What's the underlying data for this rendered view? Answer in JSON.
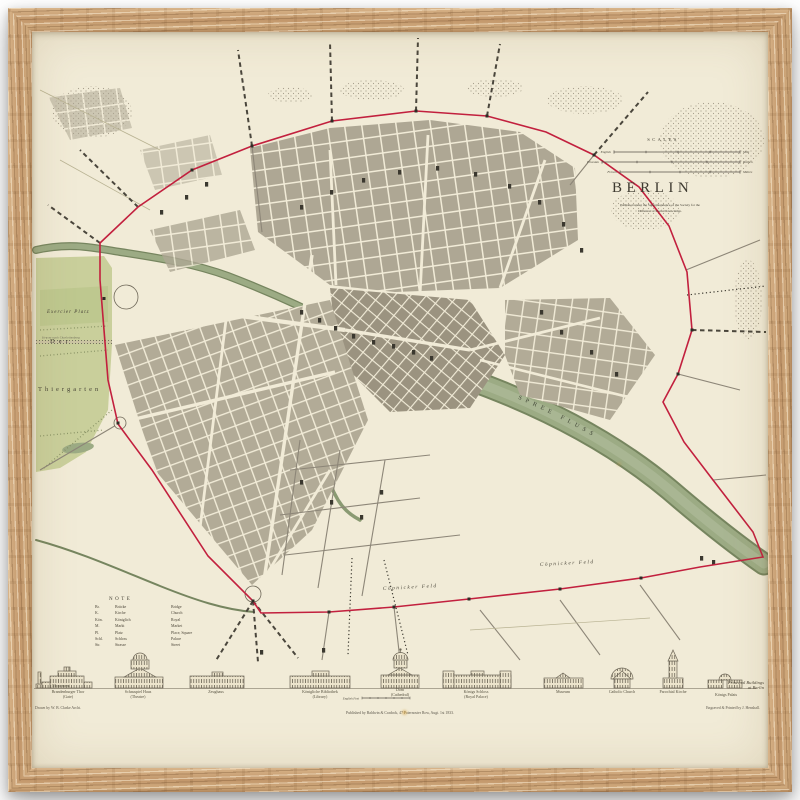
{
  "map": {
    "title": "BERLIN",
    "subtitle_1": "Published under the Superintendence of the Society for the",
    "subtitle_2": "Diffusion of Useful Knowledge.",
    "scales": {
      "heading": "SCALES",
      "rows": [
        {
          "left": "English",
          "right": "Mile"
        },
        {
          "left": "Prussian",
          "right": "Ruthen"
        },
        {
          "left": "French",
          "right": "Mètres"
        }
      ]
    },
    "labels": {
      "exercier_platz": "Exercier Platz",
      "der": "Der",
      "thiergarten": "Thiergarten",
      "charlottenburg_road": "Strasse nach Charlottenburg",
      "river": "SPREE FLUSS",
      "coepnicker_feld_w": "Cöpnicker Feld",
      "coepnicker_feld_e": "Cöpnicker Feld"
    },
    "note": {
      "heading": "NOTE",
      "abbreviations": "Br.\nK.\nKön.\nM.\nPl.\nSchl.\nStr.",
      "german": "Brücke\nKirche\nKöniglich\nMarkt\nPlatz\nSchloss\nStrasse",
      "english": "Bridge\nChurch\nRoyal\nMarket\nPlace, Square\nPalace\nStreet"
    },
    "strip": {
      "captions": [
        "Monument",
        "Brandenburger Thor\n(Gate)",
        "Schauspiel Haus\n(Theatre)",
        "Zeughaus",
        "Königliche Bibliothek\n(Library)",
        "Dom\n(Cathedral)",
        "Königs Schloss\n(Royal Palace)",
        "Museum",
        "Catholic Church",
        "Parochial Kirche",
        "Königs Palais"
      ],
      "right_title": "Principal Buildings\nat Berlin",
      "feet_scale": "English Feet"
    },
    "credits": {
      "drawn": "Drawn by W. B. Clarke Archt.",
      "published": "Published by Baldwin & Cradock, 47 Paternoster Row, Augt. 1st 1833.",
      "engraved": "Engraved & Printed by J. Henshall."
    },
    "colors": {
      "boundary_red": "#c2203e",
      "park_green": "#c9cf9b",
      "river_green": "#9cab84",
      "paper": "#f1ebd7",
      "frame_oak": "#c49a6c"
    }
  }
}
